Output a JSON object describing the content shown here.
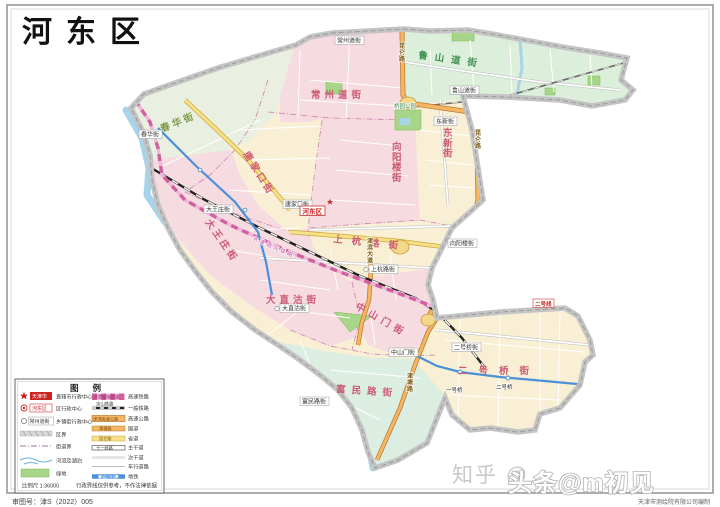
{
  "title": "河东区",
  "footer": {
    "approval": "审图号：津S（2022）005",
    "producer": "天津市测绘院有限公司编制"
  },
  "watermark": {
    "wm1": "知乎 @",
    "wm2": "头条@m初见"
  },
  "legend": {
    "title": "图例",
    "left": [
      {
        "symbol": "star-icon",
        "name": "天津市",
        "label": "直辖市行政中心"
      },
      {
        "symbol": "district-center-icon",
        "name": "河东区",
        "label": "区行政中心"
      },
      {
        "symbol": "town-center-icon",
        "name": "常州道街",
        "label": "乡镇街行政中心"
      },
      {
        "symbol": "district-boundary",
        "name": "",
        "label": "区界"
      },
      {
        "symbol": "street-boundary",
        "name": "",
        "label": "街道界"
      },
      {
        "symbol": "river",
        "name": "",
        "label": "河流及湖泊"
      },
      {
        "symbol": "greenland",
        "name": "",
        "label": "绿地"
      }
    ],
    "right": [
      {
        "symbol": "hsr",
        "name": "京津城际铁路",
        "label": "高速铁路"
      },
      {
        "symbol": "railway",
        "name": "京山铁路",
        "label": "一般铁路"
      },
      {
        "symbol": "expressway",
        "name": "津滨高速公路",
        "label": "高速公路"
      },
      {
        "symbol": "national-road",
        "name": "津塘路",
        "label": "国道"
      },
      {
        "symbol": "provincial-road",
        "name": "昆仑路",
        "label": "省道"
      },
      {
        "symbol": "main-road",
        "name": "十一经路",
        "label": "主干道"
      },
      {
        "symbol": "secondary-road",
        "name": "",
        "label": "次干道"
      },
      {
        "symbol": "minor-road",
        "name": "",
        "label": "车行道路"
      },
      {
        "symbol": "metro",
        "name": "地铁2号线",
        "label": "地铁"
      }
    ],
    "scale": "比例尺 1:36000",
    "note": "行政界线仅供参考，不作法律依据"
  },
  "map": {
    "district_marker": "河东区",
    "subdistricts": {
      "changzhoudao": "常州道街",
      "lushandao": "鲁山道街",
      "chunhua": "春华街",
      "tangjiakou": "唐家口街",
      "xiangyanglou": "向阳楼街",
      "dongxin": "东新街",
      "dawangzhuang": "大王庄街",
      "shanghanglu": "上杭路街",
      "dazhigu": "大直沽街",
      "zhongshanmen": "中山门街",
      "fuminlu": "富民路街",
      "erhaoqiao": "二号桥街"
    },
    "roads": {
      "kunlun": "昆仑路",
      "jinbin": "津滨大道",
      "jintang": "津塘路"
    },
    "railways": {
      "intercity": "京津城际铁路"
    },
    "metro": {
      "line2": "二号线",
      "station_yihaoqiao": "一号桥",
      "station_erhaoqiao": "二号桥"
    },
    "parks": {
      "qiaoyuan": "桥园公园"
    }
  },
  "colors": {
    "pink_region": "#f6dbe0",
    "cream_region": "#f8efd5",
    "green_region": "#dcefdb",
    "teal_region": "#dcede2",
    "road_orange": "#f4b662",
    "road_yellow": "#f8e088",
    "river_blue": "#a8d4ea",
    "metro_blue": "#4a90d9",
    "hsr_pink": "#d060a0",
    "park_green": "#a8d688",
    "marker_red": "#cc2222"
  }
}
